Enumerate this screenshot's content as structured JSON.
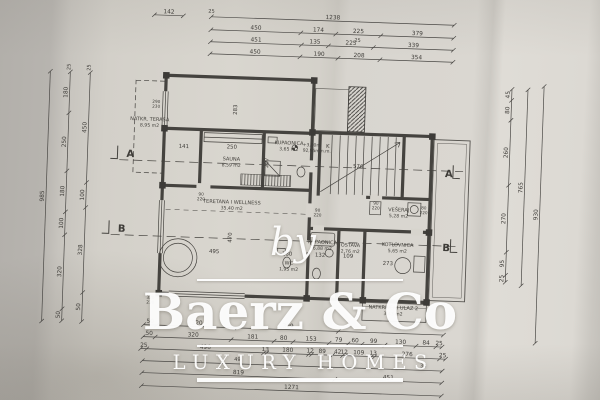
{
  "colors": {
    "paper": "#d7d4cd",
    "paper_edge_dark": "#b2afaa",
    "drawing_line": "#45433f",
    "watermark": "#ffffff"
  },
  "watermark": {
    "by": "by",
    "brand": "Baerz & Co",
    "tagline": "LUXURY HOMES"
  },
  "plan": {
    "rooms": [
      {
        "name": "NATKR. TERASA",
        "area": "8,95 m2",
        "x": 147,
        "y": 126
      },
      {
        "name": "SAUNA",
        "area": "8,59 m2",
        "x": 230,
        "y": 163
      },
      {
        "name": "KUPAONICA",
        "area": "3,65 m2",
        "x": 287,
        "y": 145
      },
      {
        "name": "TERETANA I WELLNESS",
        "area": "35,40 m2",
        "x": 232,
        "y": 206
      },
      {
        "name": "VEŠERAJ",
        "area": "5,28 m2",
        "x": 399,
        "y": 208
      },
      {
        "name": "KUPAONICA",
        "area": "6,88 m2",
        "x": 324,
        "y": 243
      },
      {
        "name": "OSTAVA",
        "area": "2,76 m2",
        "x": 352,
        "y": 245
      },
      {
        "name": "KOTLOVNICA",
        "area": "5,65 m2",
        "x": 399,
        "y": 243
      },
      {
        "name": "WC",
        "area": "1,95 m2",
        "x": 291,
        "y": 265
      },
      {
        "name": "NATKRIVENI ULAZ 2",
        "area": "3,43 m2",
        "x": 397,
        "y": 306
      }
    ],
    "sections": [
      {
        "t": "A",
        "x": 125,
        "y": 163
      },
      {
        "t": "B",
        "x": 119,
        "y": 238
      },
      {
        "t": "A",
        "x": 444,
        "y": 172
      },
      {
        "t": "B",
        "x": 444,
        "y": 246
      }
    ],
    "elevation": {
      "l1": "+3,00m",
      "l2": "92,95m n.m.",
      "x": 298,
      "y": 146
    },
    "door_labels": [
      {
        "a": "290",
        "b": "230",
        "x": 153,
        "y": 108
      },
      {
        "a": "320",
        "b": "230",
        "x": 154,
        "y": 304
      },
      {
        "a": "90",
        "b": "220",
        "x": 201,
        "y": 199
      },
      {
        "a": "90",
        "b": "220",
        "x": 318,
        "y": 211
      },
      {
        "a": "90",
        "b": "220",
        "x": 376,
        "y": 202
      },
      {
        "a": "80",
        "b": "220",
        "x": 424,
        "y": 205
      }
    ],
    "inline_dims": [
      {
        "t": "141",
        "x": 182,
        "y": 152
      },
      {
        "t": "250",
        "x": 230,
        "y": 151
      },
      {
        "t": "283",
        "x": 234,
        "y": 112,
        "v": true
      },
      {
        "t": "207",
        "x": 267,
        "y": 164,
        "v": true
      },
      {
        "t": "K",
        "x": 326,
        "y": 147
      },
      {
        "t": "576",
        "x": 357,
        "y": 166
      },
      {
        "t": "495",
        "x": 216,
        "y": 256
      },
      {
        "t": "470",
        "x": 233,
        "y": 240,
        "v": true
      },
      {
        "t": "180",
        "x": 289,
        "y": 256
      },
      {
        "t": "132",
        "x": 322,
        "y": 256
      },
      {
        "t": "109",
        "x": 350,
        "y": 256
      },
      {
        "t": "273",
        "x": 390,
        "y": 262
      }
    ],
    "extra_labels": [
      {
        "t": "25",
        "x": 205,
        "y": 16
      },
      {
        "t": "25",
        "x": 352,
        "y": 40
      },
      {
        "t": "25",
        "x": 66,
        "y": 75,
        "v": true
      },
      {
        "t": "25",
        "x": 86,
        "y": 75,
        "v": true
      },
      {
        "t": "49",
        "x": 243,
        "y": 363
      },
      {
        "t": "33",
        "x": 429,
        "y": 363
      }
    ]
  },
  "dims": {
    "top": [
      {
        "y": 20,
        "stops": [
          148,
          177
        ],
        "vals": [
          "142"
        ]
      },
      {
        "y": 20,
        "stops": [
          205,
          448
        ],
        "vals": [
          "1238"
        ]
      },
      {
        "y": 33,
        "stops": [
          205,
          295,
          330,
          375,
          448
        ],
        "vals": [
          "450",
          "174",
          "225",
          "379"
        ]
      },
      {
        "y": 45,
        "stops": [
          205,
          296,
          323,
          368,
          448
        ],
        "vals": [
          "451",
          "135",
          "225",
          "339"
        ]
      },
      {
        "y": 57,
        "stops": [
          205,
          295,
          333,
          375,
          448
        ],
        "vals": [
          "450",
          "190",
          "208",
          "354"
        ]
      }
    ],
    "left": [
      {
        "x": 46,
        "stops": [
          80,
          330
        ],
        "vals": [
          "985"
        ]
      },
      {
        "x": 66,
        "stops": [
          80,
          121,
          179,
          220,
          243,
          317,
          329
        ],
        "vals": [
          "180",
          "250",
          "180",
          "100",
          "320",
          "50"
        ]
      },
      {
        "x": 86,
        "stops": [
          80,
          190,
          215,
          300,
          329
        ],
        "vals": [
          "450",
          "100",
          "328",
          "50"
        ]
      }
    ],
    "right": [
      {
        "x": 508,
        "stops": [
          82,
          93,
          113,
          178,
          245,
          268,
          275
        ],
        "vals": [
          "45",
          "80",
          "260",
          "270",
          "95",
          "25"
        ]
      },
      {
        "x": 524,
        "stops": [
          82,
          278
        ],
        "vals": [
          "765"
        ]
      },
      {
        "x": 540,
        "stops": [
          78,
          335
        ],
        "vals": [
          "930"
        ]
      }
    ],
    "bottom": [
      {
        "y": 330,
        "stops": [
          148,
          161,
          242,
          343,
          448
        ],
        "vals": [
          "50",
          "320",
          "399",
          ""
        ]
      },
      {
        "y": 342,
        "stops": [
          148,
          160,
          236,
          279,
          298,
          334,
          353,
          367,
          390,
          421,
          441,
          447
        ],
        "vals": [
          "50",
          "320",
          "181",
          "80",
          "153",
          "79",
          "60",
          "99",
          "130",
          "84",
          "25"
        ]
      },
      {
        "y": 354,
        "stops": [
          146,
          152,
          269,
          272,
          314,
          317,
          338,
          348,
          351,
          377,
          380,
          445,
          451
        ],
        "vals": [
          "25",
          "496",
          "13",
          "180",
          "12",
          "89",
          "42",
          "12",
          "109",
          "13",
          "276",
          "25"
        ]
      },
      {
        "y": 366,
        "stops": [
          148,
          448
        ],
        "vals": [
          ""
        ]
      },
      {
        "y": 378,
        "stops": [
          148,
          341,
          448
        ],
        "vals": [
          "819",
          "451"
        ]
      },
      {
        "y": 391,
        "stops": [
          148,
          448
        ],
        "vals": [
          "1271"
        ]
      }
    ]
  }
}
